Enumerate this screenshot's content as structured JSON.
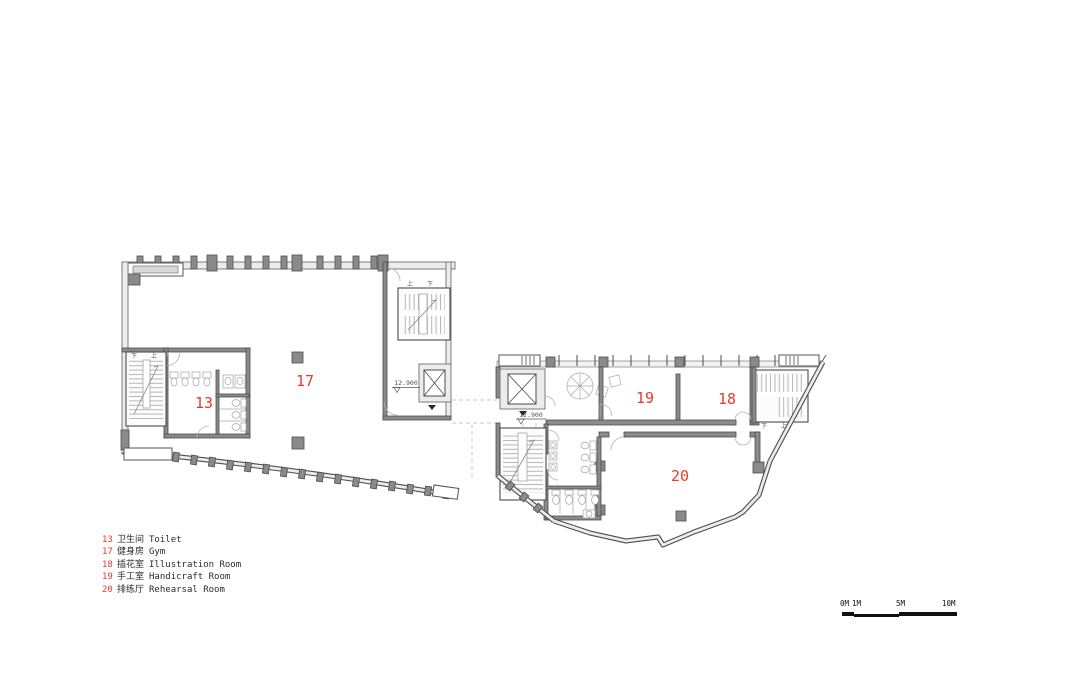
{
  "rooms": [
    {
      "number": "13",
      "zh": "卫生间",
      "en": "Toilet"
    },
    {
      "number": "17",
      "zh": "健身房",
      "en": "Gym"
    },
    {
      "number": "18",
      "zh": "插花室",
      "en": "Illustration Room"
    },
    {
      "number": "19",
      "zh": "手工室",
      "en": "Handicraft Room"
    },
    {
      "number": "20",
      "zh": "排练厅",
      "en": "Rehearsal Room"
    }
  ],
  "plan": {
    "elevation_marker": "12.900",
    "stair_up": "上",
    "stair_down": "下"
  },
  "scale_bar": {
    "labels": [
      "0M",
      "1M",
      "5M",
      "10M"
    ]
  },
  "colors": {
    "room_label_red": "#e8392e",
    "wall_fill": "#8a8a8a",
    "wall_edge": "#4c4c4c",
    "light_fill": "#ececec",
    "background": "#ffffff"
  }
}
